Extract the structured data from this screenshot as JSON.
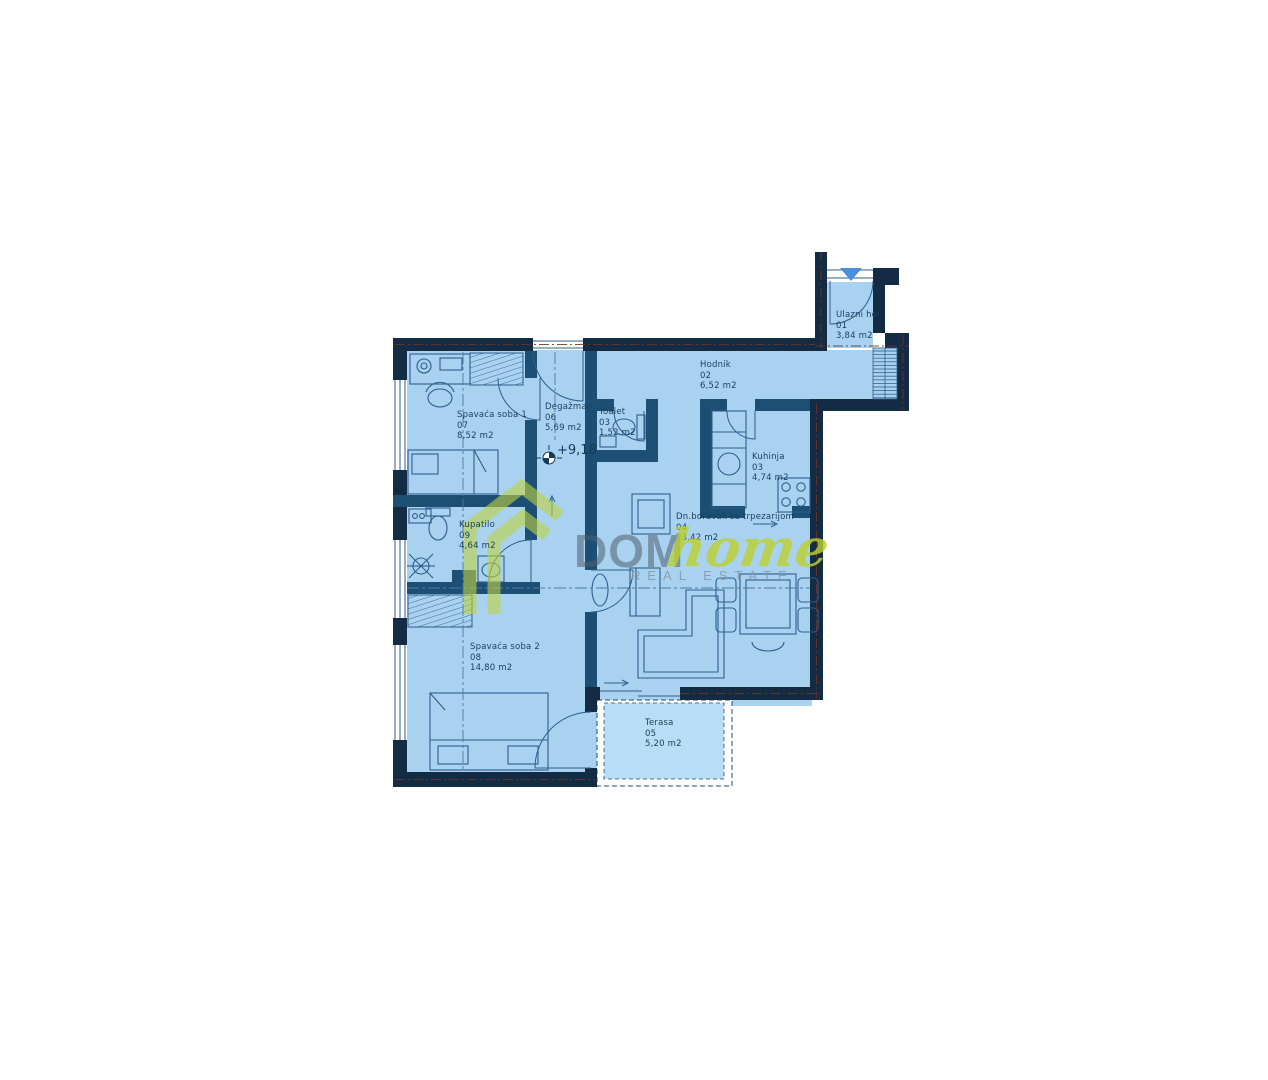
{
  "watermark": {
    "brand": "DOM",
    "brand_accent": "home",
    "tagline": "REAL ESTATE"
  },
  "plan": {
    "level_marker": "+9,18",
    "unit": "m2"
  },
  "rooms": {
    "ulazni_hol": {
      "name": "Ulazni hol",
      "number": "01",
      "area": "3,84 m2"
    },
    "hodnik": {
      "name": "Hodnik",
      "number": "02",
      "area": "6,52 m2"
    },
    "toalet": {
      "name": "Toalet",
      "number": "03",
      "area": "1,52 m2"
    },
    "kuhinja": {
      "name": "Kuhinja",
      "number": "03",
      "area": "4,74 m2"
    },
    "dnevni_boravak": {
      "name": "Dn.boravak sa trpezarijom",
      "number": "04",
      "area": "23,42 m2"
    },
    "terasa": {
      "name": "Terasa",
      "number": "05",
      "area": "5,20 m2"
    },
    "degazman": {
      "name": "Degažman",
      "number": "06",
      "area": "5,69 m2"
    },
    "spavaca_soba_1": {
      "name": "Spavaća soba 1",
      "number": "07",
      "area": "8,52 m2"
    },
    "spavaca_soba_2": {
      "name": "Spavaća soba 2",
      "number": "08",
      "area": "14,80 m2"
    },
    "kupatilo": {
      "name": "Kupatilo",
      "number": "09",
      "area": "4,64 m2"
    }
  },
  "colors": {
    "room_fill": "#a9d2f1",
    "terrace_fill": "#b9ddf6",
    "wall_exterior": "#132c44",
    "wall_interior": "#1d4f74",
    "furniture_line": "#2e5d8c",
    "entrance_arrow": "#4a90d9",
    "watermark_green": "#bccf2e",
    "watermark_gray": "#4f5f6d",
    "red_dash": "#6e3326"
  }
}
